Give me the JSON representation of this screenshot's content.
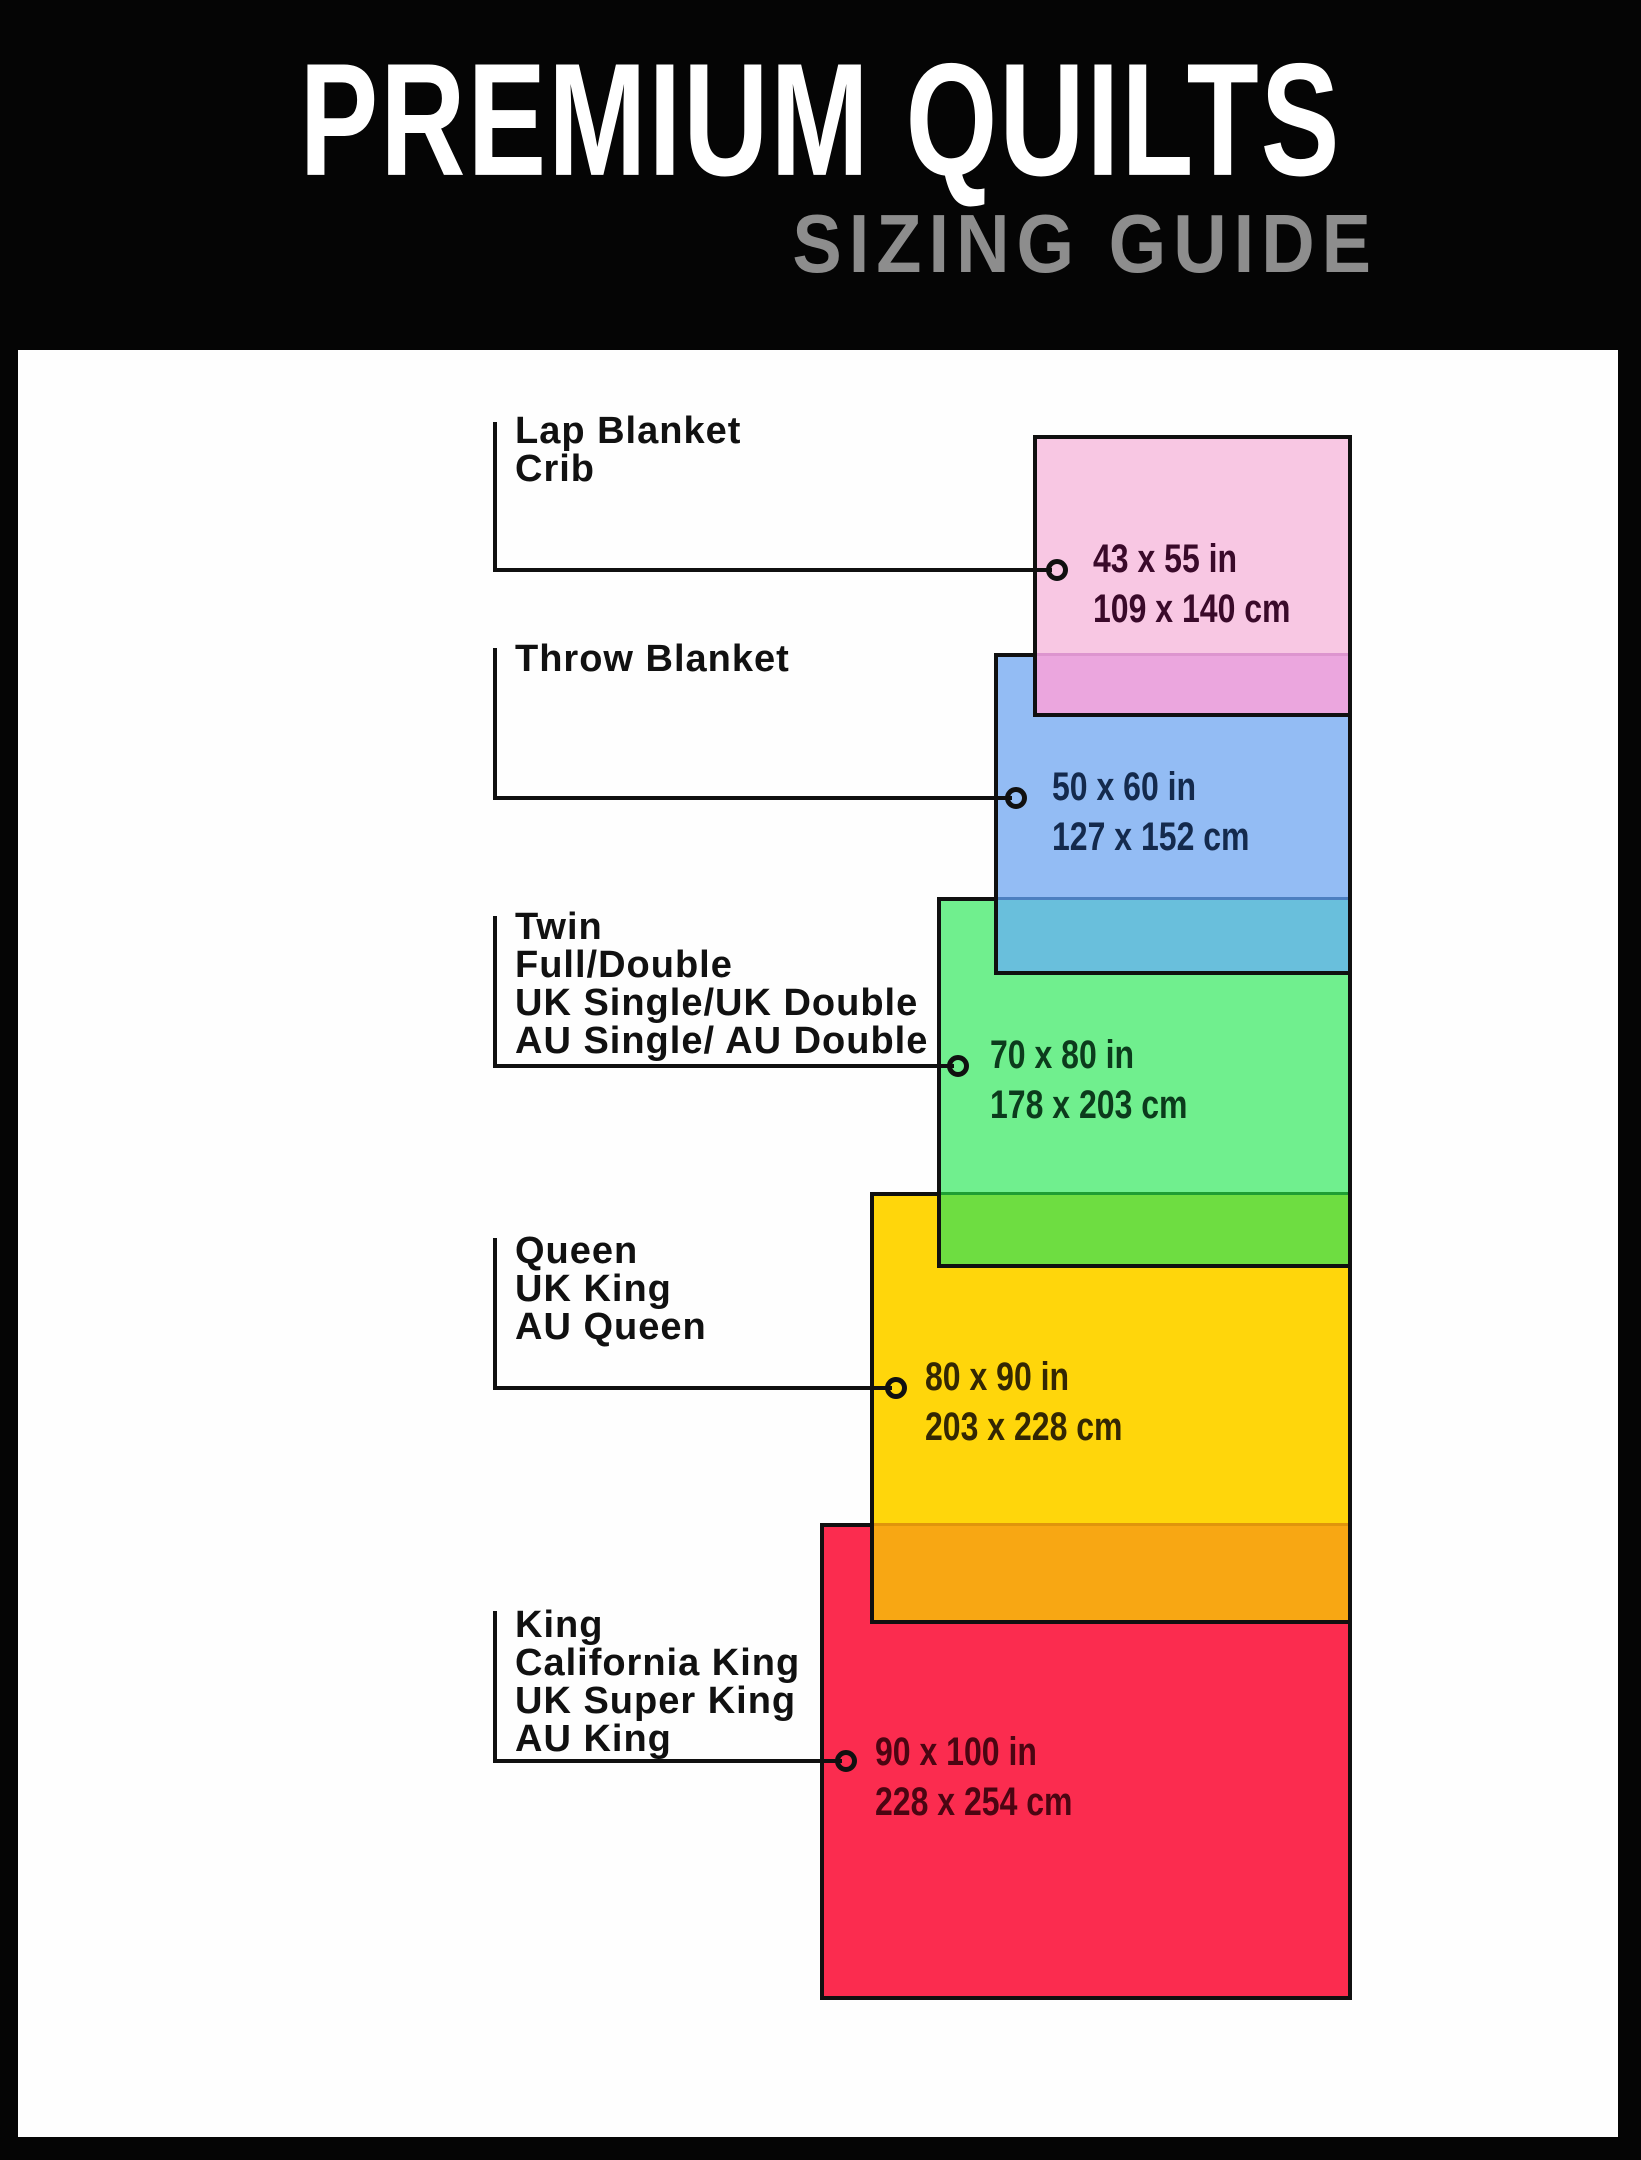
{
  "page": {
    "background": "#050505",
    "panel_background": "#fefefe",
    "line_color": "#101010"
  },
  "header": {
    "title": "PREMIUM QUILTS",
    "title_color": "#ffffff",
    "subtitle": "SIZING GUIDE",
    "subtitle_color": "#8d8d8d"
  },
  "sizes": [
    {
      "labels": [
        "Lap Blanket",
        "Crib"
      ],
      "inches": "43 x 55 in",
      "cm": "109 x 140 cm",
      "fill": "#f8c7e3",
      "overlap_fill": "#eba6de",
      "overlap_line": "#dd95cf",
      "text_color": "#3a0a2a"
    },
    {
      "labels": [
        "Throw Blanket"
      ],
      "inches": "50 x 60 in",
      "cm": "127 x 152 cm",
      "fill": "#93bcf4",
      "overlap_fill": "#69bfdc",
      "overlap_line": "#4c7fc0",
      "text_color": "#142a4d"
    },
    {
      "labels": [
        "Twin",
        "Full/Double",
        "UK Single/UK Double",
        "AU Single/ AU Double"
      ],
      "inches": "70 x 80 in",
      "cm": "178 x 203 cm",
      "fill": "#70ef8e",
      "overlap_fill": "#6edd41",
      "overlap_line": "#1e9e33",
      "text_color": "#0c3b1c"
    },
    {
      "labels": [
        "Queen",
        "UK King",
        "AU Queen"
      ],
      "inches": "80 x 90 in",
      "cm": "203 x 228 cm",
      "fill": "#ffd60b",
      "overlap_fill": "#f8a713",
      "overlap_line": "#e0950c",
      "text_color": "#332703"
    },
    {
      "labels": [
        "King",
        "California King",
        "UK Super King",
        "AU King"
      ],
      "inches": "90 x 100 in",
      "cm": "228 x 254 cm",
      "fill": "#fb2c4f",
      "text_color": "#4b0512"
    }
  ]
}
